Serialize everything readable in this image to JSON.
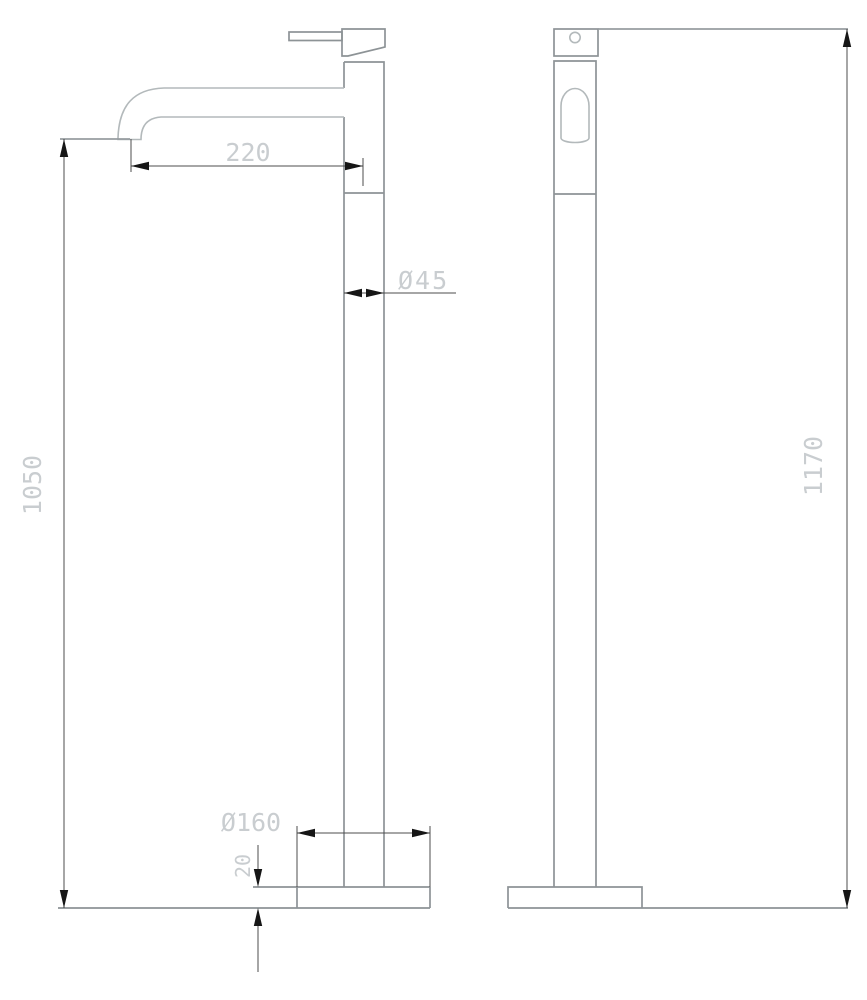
{
  "drawing": {
    "type": "technical-dimension-drawing",
    "views": {
      "side_view": "side profile with spout and handle lever",
      "front_view": "front elevation with handle circle and spout arch"
    },
    "dimensions": {
      "spout_reach": "220",
      "spout_height": "1050",
      "column_diameter": "Ø45",
      "base_diameter": "Ø160",
      "base_thickness": "20",
      "total_height": "1170"
    },
    "colors": {
      "background": "#ffffff",
      "object_outline": "#8d9396",
      "object_outline_light": "#b3b9bb",
      "dimension_line": "#4c4c4c",
      "arrowhead": "#161616",
      "dimension_text": "#c9cdd0"
    }
  }
}
